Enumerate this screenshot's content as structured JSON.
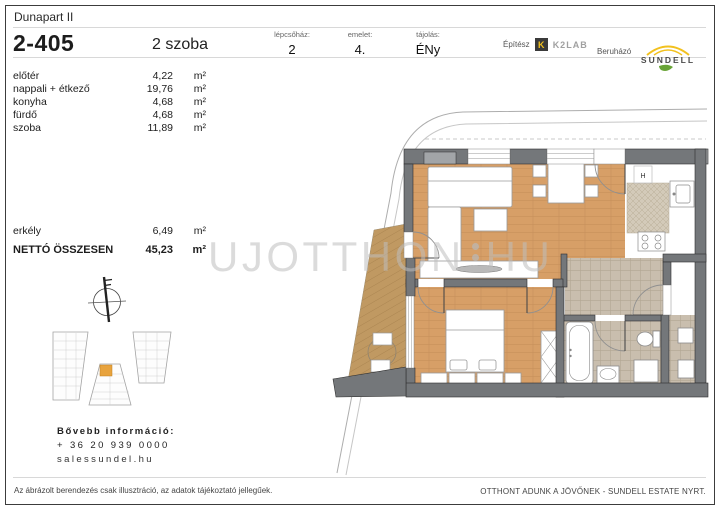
{
  "header": {
    "project": "Dunapart II",
    "unit_id": "2-405",
    "unit_type": "2 szoba"
  },
  "meta": [
    {
      "label": "lépcsőház:",
      "value": "2"
    },
    {
      "label": "emelet:",
      "value": "4."
    },
    {
      "label": "tájolás:",
      "value": "ÉNy"
    }
  ],
  "branding": {
    "architect_label": "Építész",
    "architect_mark": "K",
    "architect_name": "K2LAB",
    "developer_label": "Beruházó",
    "developer_name": "SUNDELL"
  },
  "areas": {
    "rooms": [
      {
        "name": "előtér",
        "value": "4,22",
        "unit": "m²"
      },
      {
        "name": "nappali + étkező",
        "value": "19,76",
        "unit": "m²"
      },
      {
        "name": "konyha",
        "value": "4,68",
        "unit": "m²"
      },
      {
        "name": "fürdő",
        "value": "4,68",
        "unit": "m²"
      },
      {
        "name": "szoba",
        "value": "11,89",
        "unit": "m²"
      }
    ],
    "balcony": {
      "name": "erkély",
      "value": "6,49",
      "unit": "m²"
    },
    "total": {
      "name": "NETTÓ ÖSSZESEN",
      "value": "45,23",
      "unit": "m²"
    }
  },
  "contact": {
    "title": "Bővebb információ:",
    "phone": "+ 36 20 939 0000",
    "website": "salessundel.hu"
  },
  "footer": {
    "disclaimer": "Az ábrázolt berendezés csak illusztráció, az adatok tájékoztató jellegűek.",
    "slogan": "OTTHONT ADUNK A JÖVŐNEK - SUNDELL ESTATE NYRT."
  },
  "watermark": {
    "left": "UJOTTHON",
    "right": "HU"
  },
  "plan": {
    "fridge_label": "H"
  },
  "colors": {
    "wood": "#d79f67",
    "deck": "#c09962",
    "tile": "#c9beae",
    "wall": "#74777a",
    "unit_highlight": "#e8a33d",
    "logo_yellow": "#f2c11e",
    "leaf_green": "#69a437"
  }
}
